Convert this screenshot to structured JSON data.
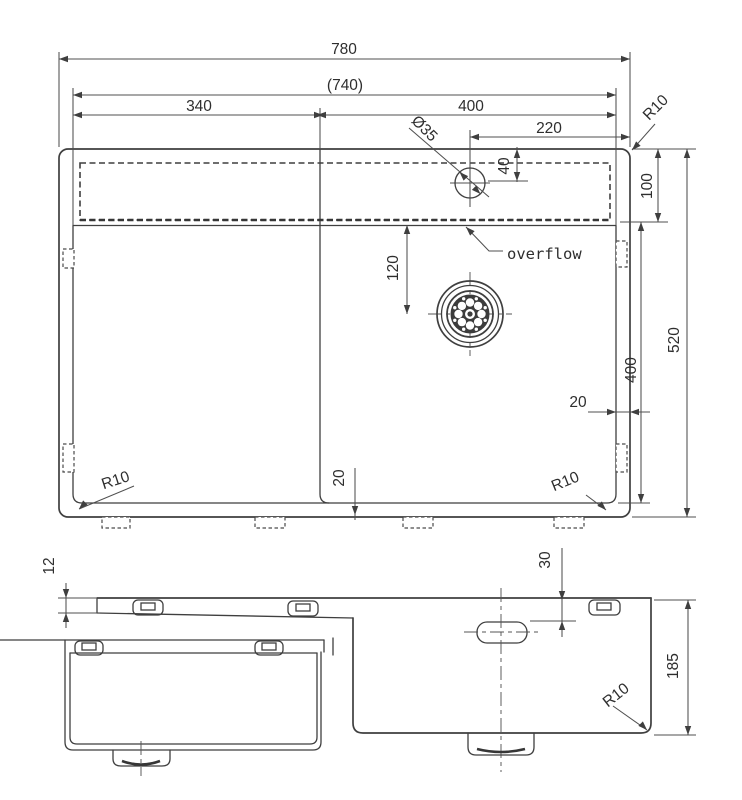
{
  "colors": {
    "line": "#3f3f3f",
    "dimension": "#4f4f4f",
    "text": "#2e2e2e",
    "background": "#ffffff"
  },
  "top_view": {
    "labels": {
      "overall_width": "780",
      "inner_width": "(740)",
      "left_bowl_width": "340",
      "right_bowl_width": "400",
      "overflow_offset": "220",
      "overflow_diameter": "Ø35",
      "overflow_drop": "40",
      "ledge_depth": "100",
      "overall_depth": "520",
      "bowl_depth": "400",
      "drain_offset": "120",
      "right_edge_gap": "20",
      "bottom_edge_gap": "20",
      "corner_top_right": "R10",
      "corner_bottom_left": "R10",
      "corner_bottom_right": "R10",
      "overflow_note": "overflow"
    }
  },
  "front_view": {
    "labels": {
      "rim_step": "12",
      "overflow_slot_drop": "30",
      "bowl_depth": "185",
      "corner_radius": "R10"
    }
  }
}
